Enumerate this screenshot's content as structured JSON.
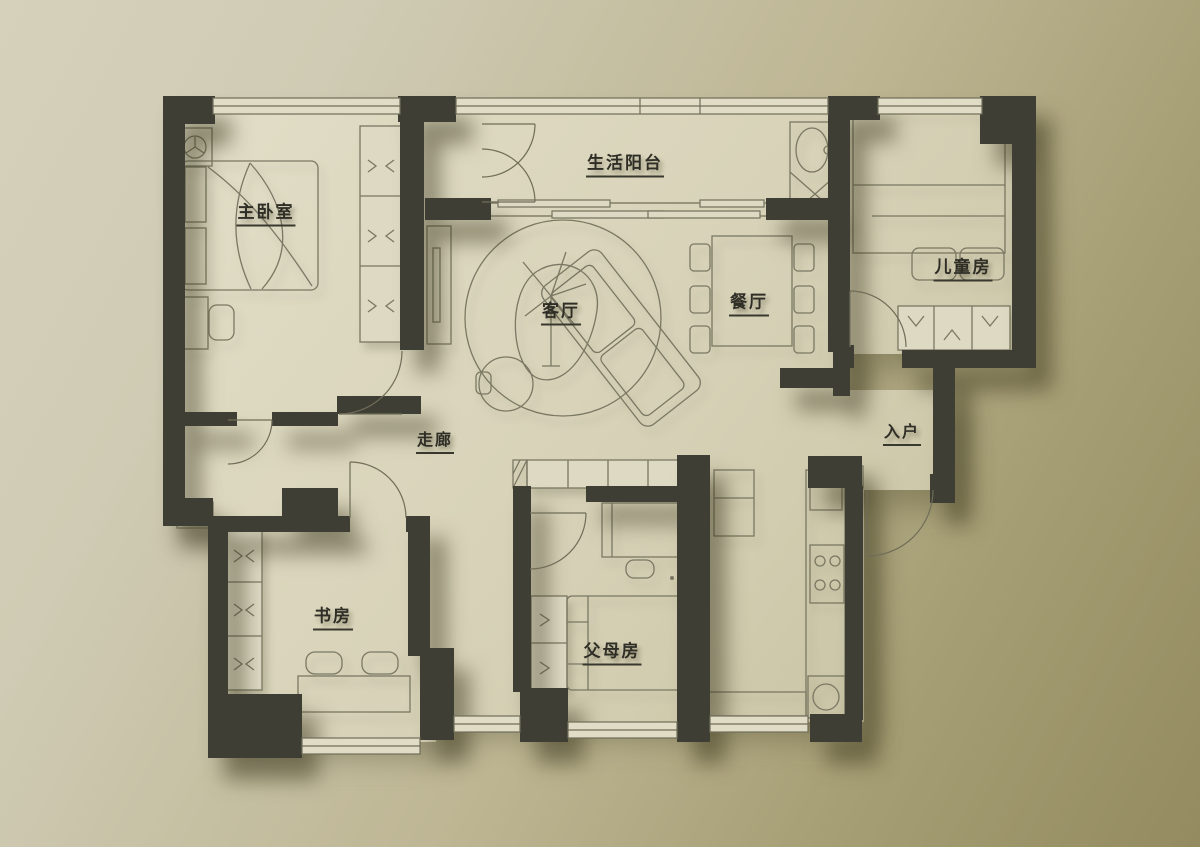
{
  "palette": {
    "background_start": "#d5d1bb",
    "background_end": "#948c60",
    "wall_color": "#3f3e35",
    "floor_light": "#e0dcc6",
    "floor_dark": "#c7c0a1",
    "furniture_line": "#7a7863",
    "label_color": "#2f2e26"
  },
  "rooms": [
    {
      "id": "master-bedroom",
      "label": "主卧室"
    },
    {
      "id": "living-balcony",
      "label": "生活阳台"
    },
    {
      "id": "children-room",
      "label": "儿童房"
    },
    {
      "id": "living-room",
      "label": "客厅"
    },
    {
      "id": "dining-room",
      "label": "餐厅"
    },
    {
      "id": "entrance",
      "label": "入户"
    },
    {
      "id": "corridor",
      "label": "走廊"
    },
    {
      "id": "study",
      "label": "书房"
    },
    {
      "id": "parents-room",
      "label": "父母房"
    }
  ],
  "icons": [
    "ceiling-fan-icon",
    "double-bed-icon",
    "wardrobe-icon",
    "sofa-icon",
    "round-rug-icon",
    "plant-icon",
    "dining-table-icon",
    "door-swing-icon",
    "sliding-door-icon",
    "window-icon",
    "fridge-icon",
    "stove-icon",
    "sink-icon",
    "desk-chair-icon",
    "washbasin-icon"
  ]
}
